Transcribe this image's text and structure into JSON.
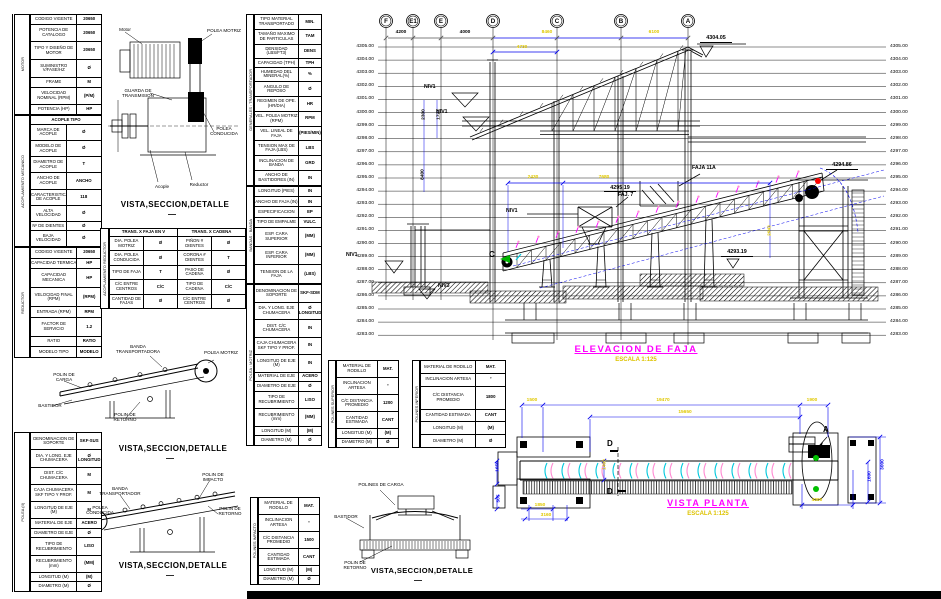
{
  "colors": {
    "magenta": "#ff00ff",
    "yellow": "#e0c800",
    "blue": "#0000ee",
    "black": "#000000",
    "green": "#00b400",
    "red": "#ff0000",
    "cyan": "#00c8dc",
    "pink": "#ff8ad2"
  },
  "titles": {
    "detail": "VISTA,SECCION,DETALLE",
    "dash": "—",
    "elevation": "ELEVACION  DE  FAJA",
    "elevation_scale": "ESCALA 1:125",
    "plan": "VISTA  PLANTA",
    "plan_scale": "ESCALA 1:125"
  },
  "tables": {
    "motor": {
      "section": "MOTOR",
      "rows": [
        [
          "CODIGO VIGENTE",
          "20650"
        ],
        [
          "POTENCIA DE CATALOGO",
          "20650"
        ],
        [
          "TIPO Y DISEÑO DE MOTOR",
          "20650"
        ],
        [
          "SUMINISTRO V/FASE/HZ",
          "Ø"
        ],
        [
          "FRAME",
          "M"
        ],
        [
          "VELOCIDAD NOMINAL (RPM)",
          "(P/M)"
        ],
        [
          "POTENCIA (HP)",
          "HP"
        ]
      ]
    },
    "acople": {
      "section": "ACOPLAMIENTO MECANICO",
      "header": "ACOPLE  TIPO",
      "rows": [
        [
          "MARCA DE ACOPLE",
          "Ø"
        ],
        [
          "MODELO DE ACOPLE",
          "Ø"
        ],
        [
          "DIAMETRO DE ACOPLE",
          "T"
        ],
        [
          "ANCHO DE ACOPLE",
          "ANCHO"
        ],
        [
          "CARACTERISTICA DE ACOPLE",
          "118"
        ],
        [
          "ALTA VELOCIDAD",
          "Ø"
        ],
        [
          "Nº DE DIENTES",
          "Ø"
        ],
        [
          "BAJA VELOCIDAD",
          "Ø"
        ]
      ]
    },
    "reductor": {
      "section": "REDUCTOR",
      "rows": [
        [
          "CODIGO VIGENTE",
          "20650"
        ],
        [
          "CAPACIDAD TERMICA",
          "HP"
        ],
        [
          "CAPACIDAD MECANICA",
          "HP"
        ],
        [
          "VELOCIDAD FINAL (RPM)",
          "(RPM)"
        ],
        [
          "ENTRADA (RPM)",
          "RPM"
        ],
        [
          "FACTOR DE SERVICIO",
          "1.2"
        ],
        [
          "RATIO",
          "RATIO"
        ],
        [
          "MODELO TIPO",
          "MODELO"
        ]
      ]
    },
    "polea_conducida": {
      "section": "POLEA (II)",
      "rows": [
        [
          "DENOMINACION DE SOPORTE",
          "SKF-SUS"
        ],
        [
          "DIA. Y LONG. EJE CHUMACERA",
          "Ø LONGITUD"
        ],
        [
          "DIST. C/C CHUMACERA",
          "M"
        ],
        [
          "CAJA CHUMACERA SKF TIPO Y PROF.",
          "M"
        ],
        [
          "LONGITUD DE EJE (M)",
          "M"
        ],
        [
          "MATERIAL DE EJE",
          "ACERO"
        ],
        [
          "DIAMETRO DE EJE",
          "Ø"
        ],
        [
          "TIPO DE RECUBRIMIENTO",
          "LISO"
        ],
        [
          "RECUBRIMIENTO (mm)",
          "(MM)"
        ],
        [
          "LONGITUD (M)",
          "(M)"
        ],
        [
          "DIAMETRO (M)",
          "Ø"
        ]
      ]
    },
    "generales": {
      "section": "GENERALES : TRANSPORTADOR",
      "rows": [
        [
          "TIPO MATERIAL TRANSPORTADO",
          "MIN."
        ],
        [
          "TAMAÑO MAXIMO DE PARTICULAS",
          "TAM"
        ],
        [
          "DENSIDAD (LBS/FT3)",
          "DENS"
        ],
        [
          "CAPACIDAD (TPH)",
          "TPH"
        ],
        [
          "HUMEDAD DEL MINERAL(%)",
          "%"
        ],
        [
          "ANGULO DE REPOSO",
          "Ø"
        ],
        [
          "REGIMEN DE OPE. (HR/DIA)",
          "HR"
        ],
        [
          "VEL. POLEA MOTRIZ (RPM)",
          "RPM"
        ],
        [
          "VEL. LINEAL DE FAJA",
          "(PIES/MIN)"
        ],
        [
          "TENSION MAX DE FAJA (LBS)",
          "LBS"
        ],
        [
          "INCLINACION DE BANDA",
          "GRD"
        ],
        [
          "ANCHO DE BASTIDORES (IN)",
          "IN"
        ]
      ]
    },
    "banda": {
      "section": "BANDAS : BANDA",
      "rows": [
        [
          "LONGITUD (PIES)",
          "IN"
        ],
        [
          "ANCHO DE FAJA (IN)",
          "IN"
        ],
        [
          "ESPECIFICACION",
          "EP"
        ],
        [
          "TIPO DE EMPALME",
          "VULC."
        ],
        [
          "ESP. CARA SUPERIOR",
          "(MM)"
        ],
        [
          "ESP. CARA INFERIOR",
          "(MM)"
        ],
        [
          "TENSION DE LA FAJA",
          "(LBS)"
        ]
      ]
    },
    "polea_motriz": {
      "section": "POLEA : MOTRIZ",
      "rows": [
        [
          "DENOMINACION DE SOPORTE",
          "SKF-SDM"
        ],
        [
          "DIA. Y LONG. EJE CHUMACERA",
          "Ø LONGITUD"
        ],
        [
          "DIST. C/C CHUMACERA",
          "IN"
        ],
        [
          "CAJA CHUMACERA SKF TIPO Y PROF.",
          "IN"
        ],
        [
          "LONGITUD DE EJE (M)",
          "IN"
        ],
        [
          "MATERIAL DE EJE",
          "ACERO"
        ],
        [
          "DIAMETRO DE EJE",
          "Ø"
        ],
        [
          "TIPO DE RECUBRIMIENTO",
          "LISO"
        ],
        [
          "RECUBRIMIENTO (mm)",
          "(MM)"
        ],
        [
          "LONGITUD (M)",
          "(M)"
        ],
        [
          "DIAMETRO (M)",
          "Ø"
        ]
      ]
    },
    "polines_superior": {
      "section": "POLINES SUPERIOR",
      "rows": [
        [
          "MATERIAL DE RODILLO",
          "MAT."
        ],
        [
          "INCLINACION ARTESA",
          "°"
        ],
        [
          "C/C DISTANCIA PROMEDIO",
          "1200"
        ],
        [
          "CANTIDAD ESTIMADA",
          "CANT"
        ],
        [
          "LONGITUD (M)",
          "(M)"
        ],
        [
          "DIAMETRO (M)",
          "Ø"
        ]
      ]
    },
    "polines_inferior": {
      "section": "POLINES INFERIOR",
      "rows": [
        [
          "MATERIAL DE RODILLO",
          "MAT."
        ],
        [
          "INCLINACION ARTESA",
          "°"
        ],
        [
          "C/C DISTANCIA PROMEDIO",
          "1800"
        ],
        [
          "CANTIDAD ESTIMADA",
          "CANT"
        ],
        [
          "LONGITUD (M)",
          "(M)"
        ],
        [
          "DIAMETRO (M)",
          "Ø"
        ]
      ]
    },
    "polines_impacto": {
      "section": "POLINES IMPACTO",
      "rows": [
        [
          "MATERIAL DE RODILLO",
          "MAT."
        ],
        [
          "INCLINACION ARTESA",
          "°"
        ],
        [
          "C/C DISTANCIA PROMEDIO",
          "1500"
        ],
        [
          "CANTIDAD ESTIMADA",
          "CANT"
        ],
        [
          "LONGITUD (M)",
          "(M)"
        ],
        [
          "DIAMETRO (M)",
          "Ø"
        ]
      ]
    },
    "acoplamiento_reductor": {
      "section": "ACOPLAMIENTO REDUCTOR",
      "headers": [
        "TRANS. X FAJA EN V",
        "TRANS. X CADENA"
      ],
      "rows": [
        [
          "DIA. POLEA MOTRIZ",
          "Ø",
          "PIÑON # DIENTES",
          "Ø"
        ],
        [
          "DIA. POLEA CONDUCIDA",
          "Ø",
          "CORONA # DIENTES",
          "T"
        ],
        [
          "TIPO DE FAJA",
          "T",
          "PASO DE CADENA",
          "Ø"
        ],
        [
          "C/C ENTRE CENTROS",
          "C/C",
          "TIPO DE CADENA",
          "C/C"
        ],
        [
          "CANTIDAD DE FAJAS",
          "Ø",
          "C/C ENTRE CENTROS",
          "Ø"
        ]
      ]
    }
  },
  "details": {
    "motor_reductor": {
      "labels": [
        {
          "t": "Motor",
          "x": 112,
          "y": 27,
          "w": 26
        },
        {
          "t": "POLEA MOTRIZ",
          "x": 206,
          "y": 28,
          "w": 36
        },
        {
          "t": "GUARDA DE TRANSMISION",
          "x": 114,
          "y": 88,
          "w": 48
        },
        {
          "t": "POLEA CONDUCIDA",
          "x": 204,
          "y": 126,
          "w": 40
        },
        {
          "t": "Acople",
          "x": 148,
          "y": 184,
          "w": 28
        },
        {
          "t": "Reductor",
          "x": 182,
          "y": 182,
          "w": 34
        }
      ]
    },
    "cabeza": {
      "labels": [
        {
          "t": "BANDA TRANSPORTADORA",
          "x": 112,
          "y": 344,
          "w": 52
        },
        {
          "t": "POLEA MOTRIZ",
          "x": 204,
          "y": 350,
          "w": 34
        },
        {
          "t": "POLIN DE CARGA",
          "x": 46,
          "y": 372,
          "w": 36
        },
        {
          "t": "BASTIDOR",
          "x": 28,
          "y": 403,
          "w": 44
        },
        {
          "t": "POLIN DE RETORNO",
          "x": 104,
          "y": 412,
          "w": 42
        }
      ]
    },
    "cola": {
      "labels": [
        {
          "t": "POLIN DE IMPACTO",
          "x": 192,
          "y": 472,
          "w": 42
        },
        {
          "t": "BANDA TRANSPORTADOR",
          "x": 96,
          "y": 486,
          "w": 48
        },
        {
          "t": "POLEA CONDUCIDA",
          "x": 80,
          "y": 505,
          "w": 40
        },
        {
          "t": "POLIN DE RETORNO",
          "x": 210,
          "y": 506,
          "w": 40
        }
      ]
    },
    "seccion": {
      "labels": [
        {
          "t": "POLINES DE CARGA",
          "x": 358,
          "y": 482,
          "w": 46
        },
        {
          "t": "BASTIDOR",
          "x": 326,
          "y": 514,
          "w": 40
        },
        {
          "t": "POLIN DE RETORNO",
          "x": 334,
          "y": 560,
          "w": 42
        }
      ]
    }
  },
  "elevation": {
    "grid_bubbles": [
      {
        "t": "F",
        "x": 386
      },
      {
        "t": "E1",
        "x": 413
      },
      {
        "t": "E",
        "x": 441
      },
      {
        "t": "D",
        "x": 493
      },
      {
        "t": "C",
        "x": 557
      },
      {
        "t": "B",
        "x": 621
      },
      {
        "t": "A",
        "x": 688
      }
    ],
    "levels": [
      "4305.00",
      "4304.00",
      "4303.00",
      "4302.00",
      "4301.00",
      "4300.00",
      "4299.00",
      "4298.00",
      "4297.00",
      "4296.00",
      "4295.00",
      "4294.00",
      "4293.00",
      "4292.00",
      "4291.00",
      "4290.00",
      "4289.00",
      "4288.00",
      "4287.00",
      "4286.00",
      "4285.00",
      "4284.00",
      "4283.00"
    ],
    "dims": [
      {
        "t": "4200",
        "x": 388,
        "y": 30,
        "c": "k"
      },
      {
        "t": "4000",
        "x": 452,
        "y": 30,
        "c": "k"
      },
      {
        "t": "8460",
        "x": 534,
        "y": 30,
        "c": "y"
      },
      {
        "t": "6100",
        "x": 641,
        "y": 30,
        "c": "y"
      },
      {
        "t": "4730",
        "x": 509,
        "y": 44.5,
        "c": "y"
      },
      {
        "t": "2430",
        "x": 520,
        "y": 175,
        "c": "y"
      },
      {
        "t": "7680",
        "x": 591,
        "y": 175,
        "c": "y"
      },
      {
        "t": "2943",
        "x": 757,
        "y": 228,
        "c": "y",
        "rot": 1
      },
      {
        "t": "2300",
        "x": 411,
        "y": 112,
        "c": "k",
        "rot": 1
      },
      {
        "t": "1721",
        "x": 426,
        "y": 112,
        "c": "k",
        "rot": 1
      },
      {
        "t": "8400",
        "x": 410,
        "y": 172,
        "c": "k",
        "rot": 1
      }
    ],
    "marks": [
      {
        "t": "4304.05",
        "x": 700,
        "y": 35
      },
      {
        "t": "4294.86",
        "x": 826,
        "y": 162
      },
      {
        "t": "4295.19",
        "x": 604,
        "y": 184.5
      },
      {
        "t": "4293.19",
        "x": 721,
        "y": 249
      }
    ],
    "notes": [
      {
        "t": "NIV1",
        "x": 424,
        "y": 84
      },
      {
        "t": "NIV1",
        "x": 436,
        "y": 109
      },
      {
        "t": "NIV1",
        "x": 346,
        "y": 252
      },
      {
        "t": "NIV3",
        "x": 438,
        "y": 283
      },
      {
        "t": "NIV1",
        "x": 506,
        "y": 208
      },
      {
        "t": "FAJA 11A",
        "x": 692,
        "y": 165,
        "w": 34
      },
      {
        "t": "FAJ. 7",
        "x": 618,
        "y": 192
      },
      {
        "t": "C",
        "x": 489,
        "y": 250,
        "big": 1
      }
    ]
  },
  "plan": {
    "dims": [
      {
        "t": "1500",
        "x": 519,
        "y": 398,
        "c": "y"
      },
      {
        "t": "19470",
        "x": 650,
        "y": 398,
        "c": "y"
      },
      {
        "t": "1900",
        "x": 799,
        "y": 398,
        "c": "y"
      },
      {
        "t": "15650",
        "x": 672,
        "y": 410,
        "c": "y"
      },
      {
        "t": "4000",
        "x": 804,
        "y": 498,
        "c": "y"
      },
      {
        "t": "1850",
        "x": 527,
        "y": 503,
        "c": "y"
      },
      {
        "t": "3160",
        "x": 533,
        "y": 513,
        "c": "y"
      },
      {
        "t": "1650",
        "x": 485,
        "y": 464,
        "c": "b",
        "rot": 1
      },
      {
        "t": "505",
        "x": 486,
        "y": 496,
        "c": "b",
        "rot": 1
      },
      {
        "t": "1400",
        "x": 592,
        "y": 462,
        "c": "y",
        "rot": 1
      },
      {
        "t": "3000",
        "x": 870,
        "y": 462,
        "c": "b",
        "rot": 1
      },
      {
        "t": "1600",
        "x": 857,
        "y": 474,
        "c": "b",
        "rot": 1
      }
    ],
    "markers": [
      {
        "t": "D",
        "x": 607,
        "y": 439
      },
      {
        "t": "D",
        "x": 607,
        "y": 487
      },
      {
        "t": "A",
        "x": 823,
        "y": 425
      }
    ]
  }
}
